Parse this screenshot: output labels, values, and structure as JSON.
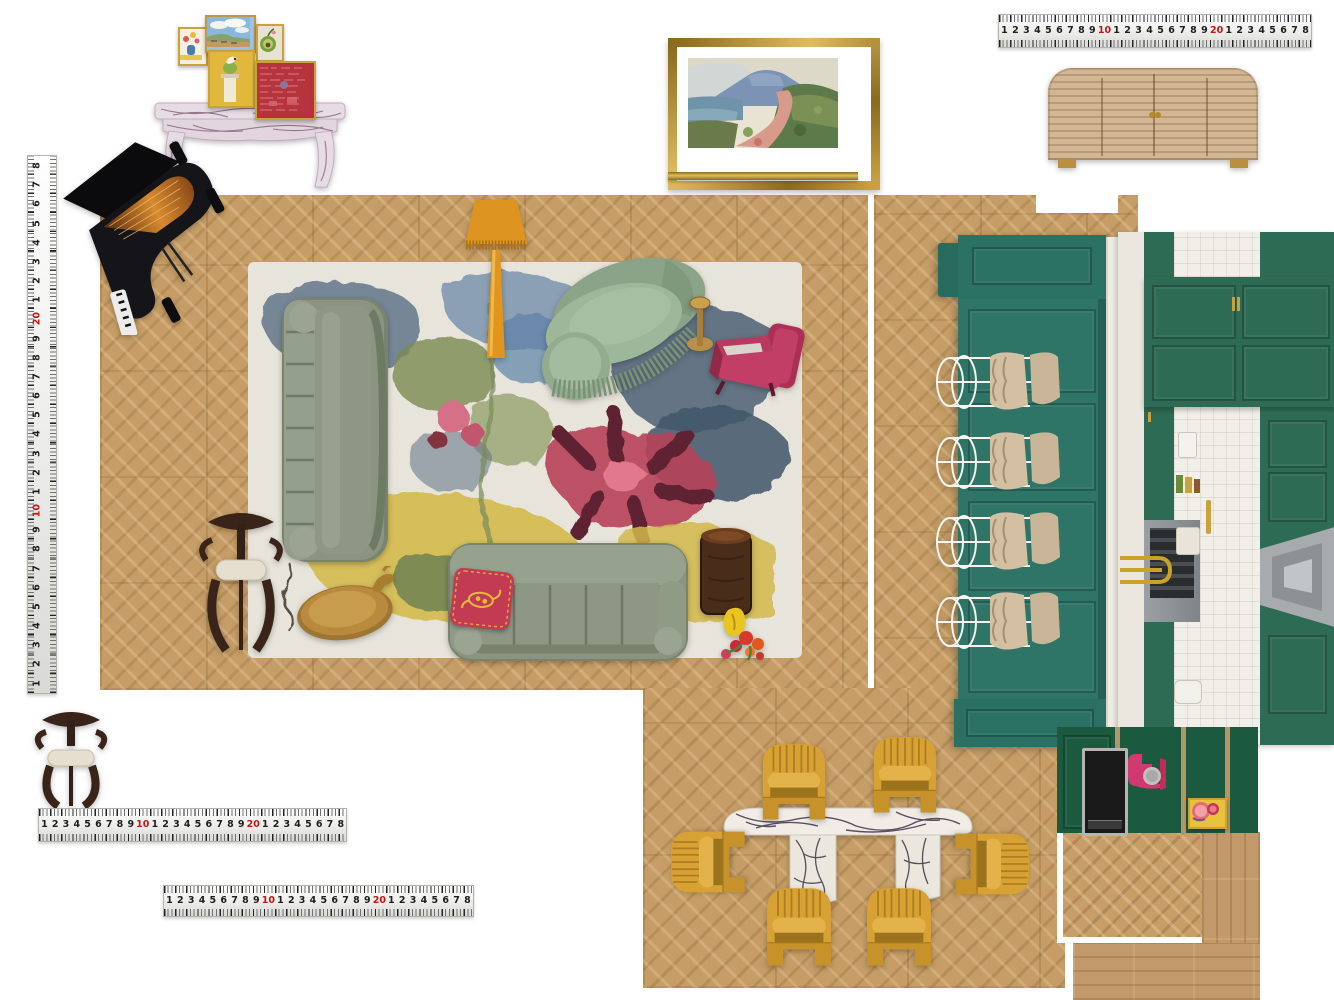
{
  "ruler": {
    "sequence": [
      "1",
      "2",
      "3",
      "4",
      "5",
      "6",
      "7",
      "8",
      "9",
      "10",
      "1",
      "2",
      "3",
      "4",
      "5",
      "6",
      "7",
      "8",
      "9",
      "20",
      "1",
      "2",
      "3",
      "4",
      "5",
      "6",
      "7",
      "8"
    ],
    "red_values": [
      "10",
      "20"
    ]
  },
  "palette": {
    "floor_oak": "#c69d66",
    "island_teal": "#2b7164",
    "kitchen_green": "#2e6b55",
    "cabinet_green": "#1c5a40",
    "mustard": "#d8a133",
    "sofa_sage": "#8a9481",
    "chaise_sage": "#9db79a",
    "magenta": "#b73a5f",
    "raspberry": "#c23b52",
    "lamp_orange": "#de9420",
    "marble_white": "#f1ede6",
    "gold": "#b8872b",
    "walnut": "#3a241a",
    "cream": "#e6decf",
    "ruler_red": "#c41414"
  },
  "items": {
    "piano": "grand-piano",
    "console": "marble-console-table",
    "gallery": [
      "floral-still-life",
      "cloud-landscape",
      "green-fruit-study",
      "bird-on-pedestal",
      "red-abstract"
    ],
    "painting": "coastal-landscape-painting",
    "painting_profile": "gold-frame-side-profile",
    "sideboard": "cane-slat-sideboard",
    "rug": "floral-area-rug",
    "sofa_left": "sage-velvet-sofa-vertical",
    "sofa_bottom": "sage-velvet-sofa-horizontal",
    "chaise": "fringed-chaise-lounge",
    "floor_lamp": "fringed-floor-lamp",
    "armchair": "magenta-velvet-armchair",
    "martini_table": "brass-martini-side-table",
    "drum_table": "burl-wood-drum-table",
    "tray_table": "brass-tray-coffee-table",
    "accent_chair_rug": "carved-wood-accent-chair",
    "accent_chair_bottom": "carved-wood-armchair",
    "pillow": "embroidered-raspberry-pillow",
    "vase": "yellow-vase-with-flowers",
    "island": "green-kitchen-island",
    "bar_stool": "scalloped-bar-stool",
    "kitchen_photo": "green-kitchen-photo",
    "dining_table": "viola-marble-dining-table",
    "dining_chair": "mustard-velvet-tub-chair",
    "cabinet_run": "green-cabinet-fronts",
    "appliance": "built-in-appliance",
    "mixer": "pink-stand-mixer",
    "fruit_art": "fruit-art-tile",
    "swatch_herringbone": "herringbone-oak-swatch",
    "swatch_planks": "oak-plank-swatch"
  }
}
